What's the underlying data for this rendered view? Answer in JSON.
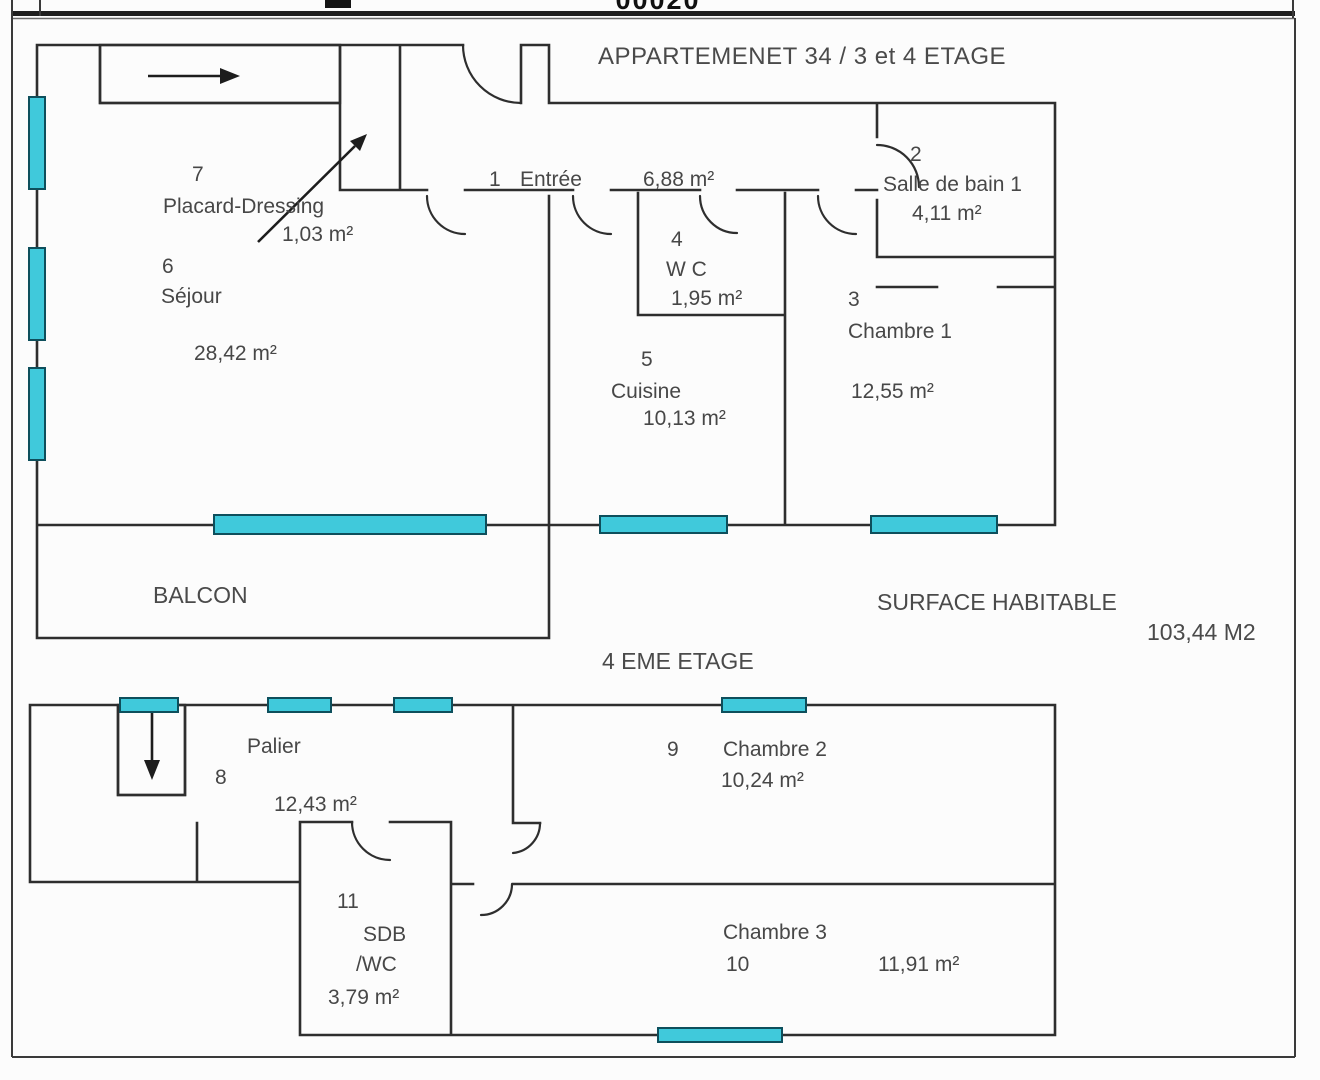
{
  "header": {
    "doc_number": "00020"
  },
  "colors": {
    "wall": "#2e2e2e",
    "window_fill": "#40c9db",
    "window_stroke": "#0e4f5c",
    "text": "#474747"
  },
  "floor1": {
    "title": "APPARTEMENET 34 / 3 et 4 ETAGE",
    "rooms": [
      {
        "number": "1",
        "name": "Entrée",
        "area": "6,88 m²"
      },
      {
        "number": "2",
        "name": "Salle de bain 1",
        "area": "4,11 m²"
      },
      {
        "number": "3",
        "name": "Chambre 1",
        "area": "12,55 m²"
      },
      {
        "number": "4",
        "name": "W C",
        "area": "1,95 m²"
      },
      {
        "number": "5",
        "name": "Cuisine",
        "area": "10,13 m²"
      },
      {
        "number": "6",
        "name": "Séjour",
        "area": "28,42 m²"
      },
      {
        "number": "7",
        "name": "Placard-Dressing",
        "area": "1,03 m²"
      }
    ],
    "balcony": "BALCON",
    "surface_label": "SURFACE HABITABLE",
    "surface_value": "103,44 M2"
  },
  "floor2": {
    "title": "4 EME ETAGE",
    "rooms": [
      {
        "number": "8",
        "name": "Palier",
        "area": "12,43 m²"
      },
      {
        "number": "9",
        "name": "Chambre 2",
        "area": "10,24 m²"
      },
      {
        "number": "10",
        "name": "Chambre 3",
        "area": "11,91 m²"
      },
      {
        "number": "11",
        "name": "SDB",
        "name_line2": "/WC",
        "area": "3,79 m²"
      }
    ]
  }
}
